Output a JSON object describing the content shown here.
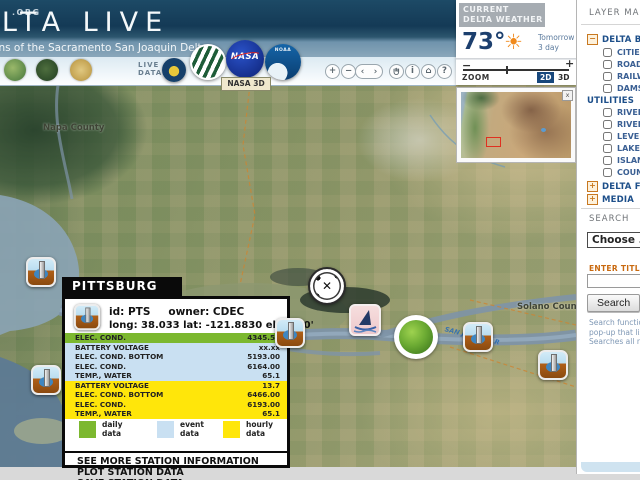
{
  "header": {
    "site": ".ORG",
    "title": "DELTA LIVE",
    "subtitle": "Conditions of the Sacramento San Joaquin Delta"
  },
  "toolbar": {
    "live_data": "LIVE DATA",
    "nasa_tooltip": "NASA 3D",
    "logos": {
      "nasa": "NASA",
      "noaa": "NOAA"
    },
    "nav": {
      "zoom_in": "+",
      "zoom_out": "−",
      "prev": "‹",
      "next": "›",
      "info": "i",
      "home": "⌂",
      "help": "?"
    }
  },
  "weather": {
    "title_line1": "CURRENT",
    "title_line2": "DELTA WEATHER",
    "temperature": "73°",
    "sun_icon": "☀",
    "link_tomorrow": "Tomorrow",
    "link_3day": "3 day",
    "minus": "−",
    "plus": "+",
    "zoom_label": "ZOOM",
    "btn_2d": "2D",
    "btn_3d": "3D"
  },
  "inset": {
    "close": "x"
  },
  "map": {
    "labels": {
      "napa": "Napa County",
      "solano_left": "Solano Co",
      "solano_right": "Solano County",
      "river": "SAN JOAQUIN R"
    },
    "crosshair_glyph": "✕"
  },
  "popup": {
    "title": "PITTSBURG",
    "station": {
      "id_text": "id: PTS",
      "owner_text": "owner: CDEC",
      "coords": "long: 38.033  lat: -121.8830  elev: 10'"
    },
    "rows": [
      {
        "param": "ELEC. COND.",
        "value": "4345.50",
        "series": "daily"
      },
      {
        "param": "BATTERY VOLTAGE",
        "value": "xx.xx",
        "series": "event"
      },
      {
        "param": "ELEC. COND. BOTTOM",
        "value": "5193.00",
        "series": "event"
      },
      {
        "param": "ELEC. COND.",
        "value": "6164.00",
        "series": "event"
      },
      {
        "param": "TEMP., WATER",
        "value": "65.1",
        "series": "event"
      },
      {
        "param": "BATTERY VOLTAGE",
        "value": "13.7",
        "series": "hourly"
      },
      {
        "param": "ELEC. COND. BOTTOM",
        "value": "6466.00",
        "series": "hourly"
      },
      {
        "param": "ELEC. COND.",
        "value": "6193.00",
        "series": "hourly"
      },
      {
        "param": "TEMP., WATER",
        "value": "65.1",
        "series": "hourly"
      }
    ],
    "legend": [
      {
        "line1": "daily",
        "line2": "data",
        "color": "#7cb82f"
      },
      {
        "line1": "event",
        "line2": "data",
        "color": "#c9e0f2"
      },
      {
        "line1": "hourly",
        "line2": "data",
        "color": "#ffe60a"
      }
    ],
    "links": [
      "SEE MORE STATION INFORMATION",
      "PLOT STATION DATA",
      "SAVE STATION DATA"
    ]
  },
  "sidebar": {
    "title": "LAYER MANAGER",
    "base": {
      "label": "DELTA BASE LAYERS",
      "items": [
        "CITIES",
        "ROADS",
        "RAILWAYS",
        "DAMS"
      ]
    },
    "utilities": {
      "label": "UTILITIES",
      "items": [
        "RIVER/STREAMS",
        "RIVER/CHANNELS",
        "LEVEES",
        "LAKES",
        "ISLANDS",
        "COUNTIES"
      ]
    },
    "features_label": "DELTA FEATURES",
    "media_label": "MEDIA",
    "search": {
      "title": "SEARCH",
      "choose": "Choose ...",
      "enter_title": "ENTER TITLE",
      "button": "Search",
      "help_lines": [
        "Search functio",
        "pop-up that lis",
        "Searches all n"
      ]
    }
  }
}
